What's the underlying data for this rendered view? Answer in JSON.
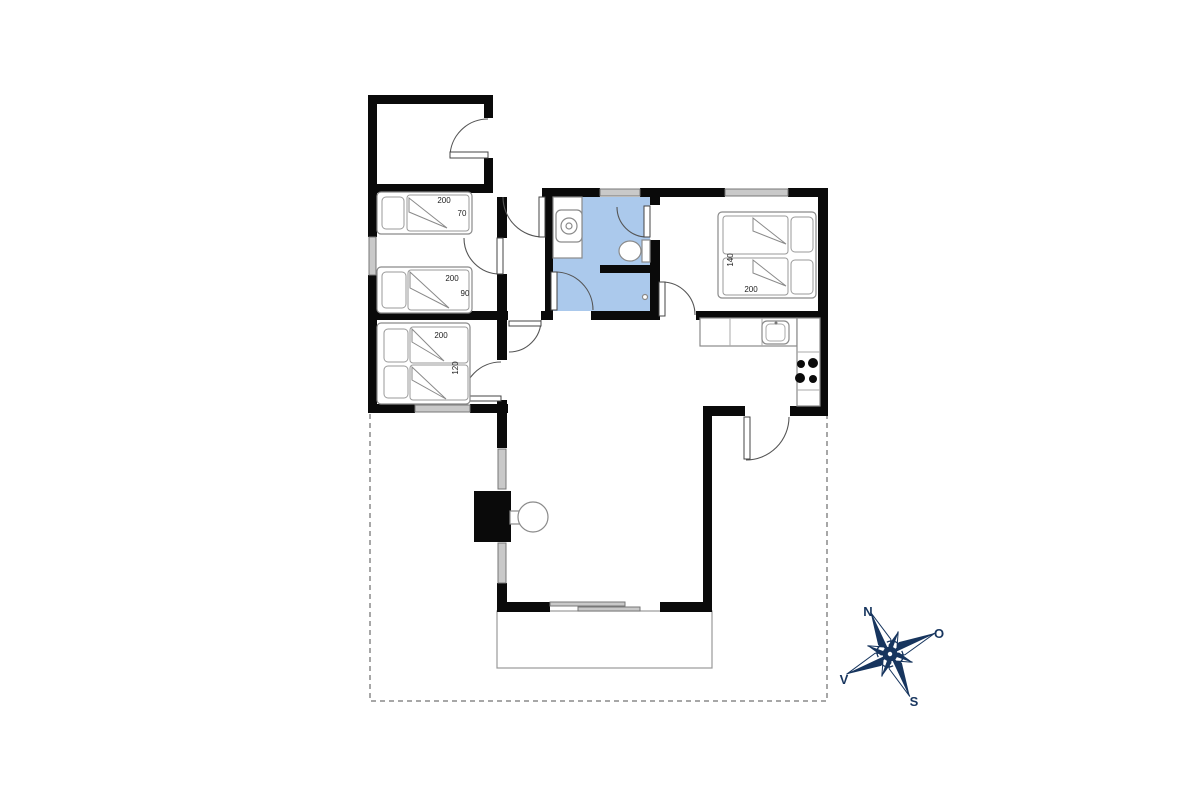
{
  "colors": {
    "wall": "#0a0a0a",
    "bathroom": "#abc9ec",
    "window": "#c9c9c9",
    "navy": "#17355e"
  },
  "beds": [
    {
      "name": "single-bed-70",
      "length": "200",
      "width": "70"
    },
    {
      "name": "single-bed-90",
      "length": "200",
      "width": "90"
    },
    {
      "name": "double-bed-120",
      "length": "200",
      "width": "120"
    },
    {
      "name": "double-bed-140",
      "length": "200",
      "width": "140"
    }
  ],
  "compass": {
    "n": "N",
    "e": "O",
    "s": "S",
    "w": "V"
  }
}
